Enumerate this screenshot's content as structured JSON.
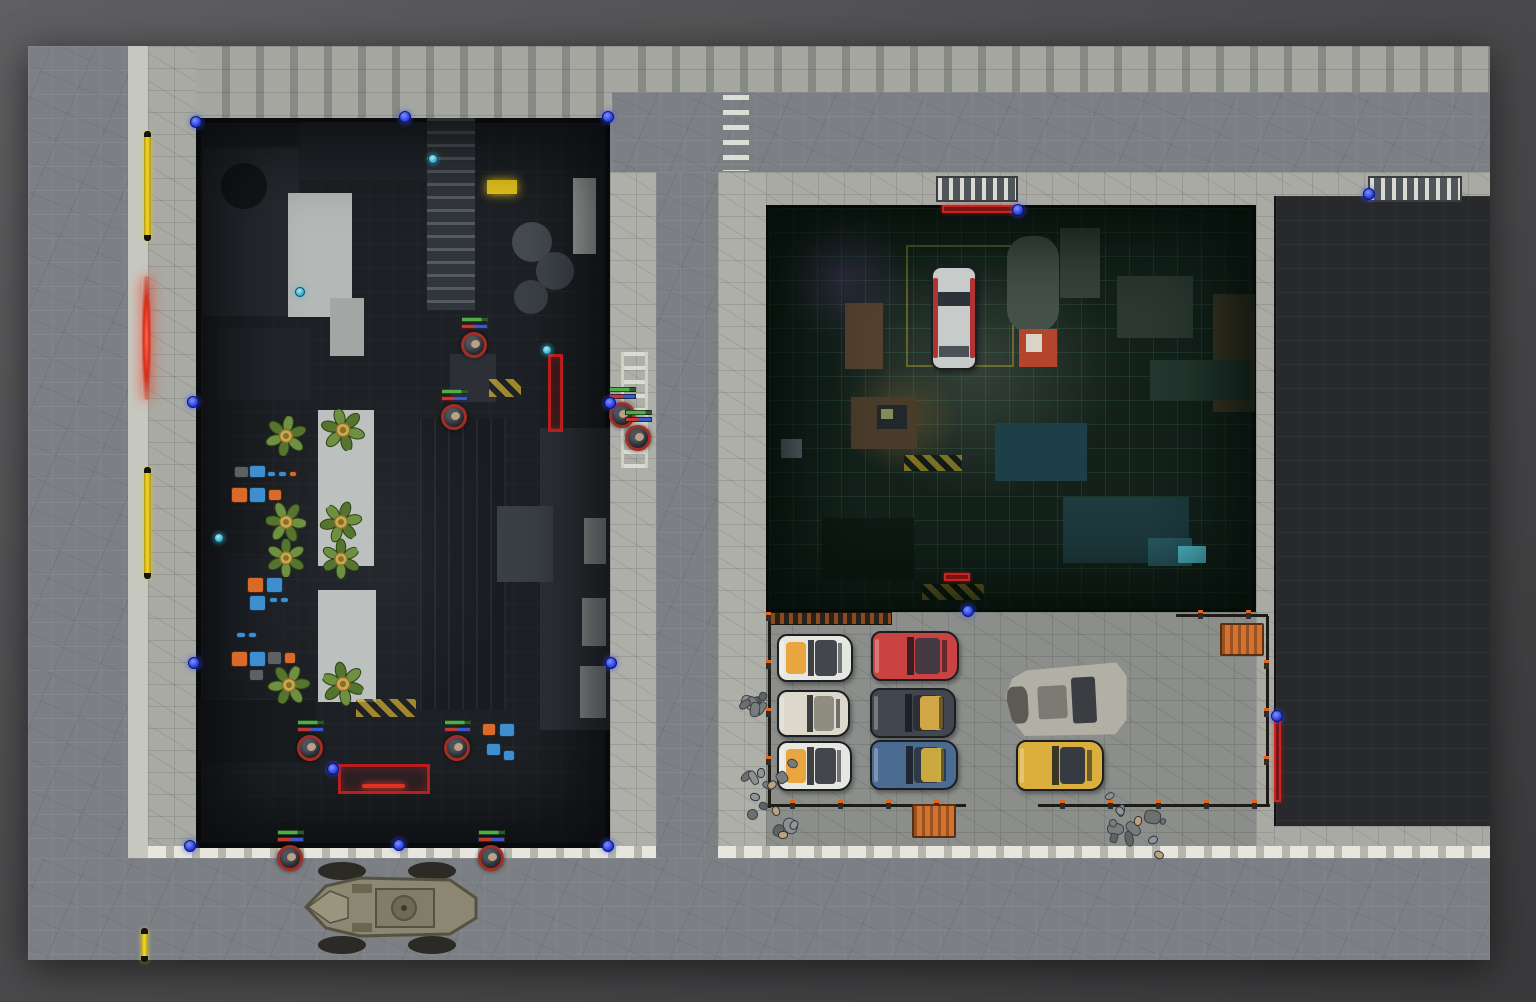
{
  "canvas": {
    "w": 1536,
    "h": 1002
  },
  "scene": {
    "x": 28,
    "y": 46,
    "w": 1462,
    "h": 914,
    "road_color": "#7c8085",
    "pave_color": "#a9aaa3",
    "dark_building_color": "#1d2024",
    "garage_color": "#14211b",
    "black_building_color": "#28292c",
    "grid_size_px": 24
  },
  "regions": [
    {
      "n": "scene-base",
      "i": false,
      "x": 28,
      "y": 46,
      "w": 1462,
      "h": 914,
      "f": "#7c8085",
      "cls": "shadowed"
    },
    {
      "n": "road-vertical-left",
      "i": false,
      "x": 28,
      "y": 46,
      "w": 100,
      "h": 914,
      "f": "#7c8085",
      "cls": "road"
    },
    {
      "n": "curb-left",
      "i": false,
      "x": 128,
      "y": 46,
      "w": 20,
      "h": 914,
      "f": "#c6c7bf",
      "cls": ""
    },
    {
      "n": "sidewalk-left",
      "i": false,
      "x": 148,
      "y": 46,
      "w": 48,
      "h": 914,
      "f": "#a9aaa3",
      "cls": "pave"
    },
    {
      "n": "frontage-top-west",
      "i": false,
      "x": 196,
      "y": 46,
      "w": 416,
      "h": 72,
      "f": "#a6a7a0",
      "cls": "facade"
    },
    {
      "n": "frontage-top-east",
      "i": false,
      "x": 612,
      "y": 46,
      "w": 878,
      "h": 46,
      "f": "#a6a7a0",
      "cls": "facade"
    },
    {
      "n": "road-horizontal-top",
      "i": false,
      "x": 612,
      "y": 92,
      "w": 878,
      "h": 80,
      "f": "#7c8085",
      "cls": "road"
    },
    {
      "n": "sidewalk-mid-west",
      "i": false,
      "x": 610,
      "y": 172,
      "w": 46,
      "h": 788,
      "f": "#aeafa8",
      "cls": "pave"
    },
    {
      "n": "road-vertical-mid",
      "i": false,
      "x": 656,
      "y": 172,
      "w": 62,
      "h": 788,
      "f": "#7c8085",
      "cls": "road"
    },
    {
      "n": "sidewalk-mid-east",
      "i": false,
      "x": 718,
      "y": 172,
      "w": 48,
      "h": 788,
      "f": "#aeafa8",
      "cls": "pave"
    },
    {
      "n": "frontage-garage-top",
      "i": false,
      "x": 766,
      "y": 172,
      "w": 724,
      "h": 33,
      "f": "#a9aaa3",
      "cls": "pave"
    },
    {
      "n": "gutter-right",
      "i": false,
      "x": 1256,
      "y": 172,
      "w": 34,
      "h": 676,
      "f": "#a9aaa3",
      "cls": "pave"
    },
    {
      "n": "parking-lot",
      "i": false,
      "x": 766,
      "y": 612,
      "w": 490,
      "h": 236,
      "f": "#8b8e8a",
      "cls": "pave"
    },
    {
      "n": "pave-southeast",
      "i": false,
      "x": 1274,
      "y": 826,
      "w": 216,
      "h": 22,
      "f": "#a9aaa3",
      "cls": "pave"
    },
    {
      "n": "curb-bottom-west",
      "i": false,
      "x": 148,
      "y": 846,
      "w": 508,
      "h": 12,
      "f": "#c9c9c0",
      "cls": "curb"
    },
    {
      "n": "curb-bottom-east",
      "i": false,
      "x": 718,
      "y": 846,
      "w": 772,
      "h": 12,
      "f": "#c9c9c0",
      "cls": "curb"
    },
    {
      "n": "road-horizontal-bottom",
      "i": false,
      "x": 28,
      "y": 858,
      "w": 1462,
      "h": 102,
      "f": "#7c8085",
      "cls": "road"
    },
    {
      "n": "building-dark-interior",
      "i": false,
      "x": 196,
      "y": 118,
      "w": 414,
      "h": 730,
      "f": "#1d2024",
      "cls": "bgrid"
    },
    {
      "n": "garage-room-interior",
      "i": false,
      "x": 766,
      "y": 205,
      "w": 490,
      "h": 407,
      "f": "#14211b",
      "cls": "ggrid"
    },
    {
      "n": "building-black-roof",
      "i": false,
      "x": 1274,
      "y": 196,
      "w": 216,
      "h": 630,
      "f": "#28292c",
      "cls": "kgrid"
    }
  ],
  "building_shapes": [
    {
      "n": "machinery-block",
      "x": 203,
      "y": 148,
      "w": 96,
      "h": 168,
      "f": "#262a2f"
    },
    {
      "n": "vent-circle",
      "x": 221,
      "y": 163,
      "w": 46,
      "h": 46,
      "f": "#141619",
      "r": "50%"
    },
    {
      "n": "machinery-block",
      "x": 300,
      "y": 122,
      "w": 168,
      "h": 58,
      "f": "#22262b"
    },
    {
      "n": "conveyor-belt",
      "x": 427,
      "y": 118,
      "w": 48,
      "h": 192,
      "f": "#31363c",
      "cls": "rungs"
    },
    {
      "n": "white-counter",
      "x": 288,
      "y": 193,
      "w": 64,
      "h": 124,
      "f": "#b4b8b7"
    },
    {
      "n": "white-counter-small",
      "x": 330,
      "y": 298,
      "w": 34,
      "h": 58,
      "f": "#a2a6a5"
    },
    {
      "n": "white-shelf",
      "x": 573,
      "y": 178,
      "w": 23,
      "h": 76,
      "f": "#aeb2b0"
    },
    {
      "n": "dark-cabinet",
      "x": 218,
      "y": 328,
      "w": 92,
      "h": 72,
      "f": "#22252a"
    },
    {
      "n": "tank-circle",
      "x": 512,
      "y": 222,
      "w": 40,
      "h": 40,
      "f": "#474c52",
      "r": "50%"
    },
    {
      "n": "tank-circle",
      "x": 536,
      "y": 252,
      "w": 38,
      "h": 38,
      "f": "#42474d",
      "r": "50%"
    },
    {
      "n": "tank-circle",
      "x": 514,
      "y": 280,
      "w": 34,
      "h": 34,
      "f": "#3d4248",
      "r": "50%"
    },
    {
      "n": "machine-box",
      "x": 450,
      "y": 354,
      "w": 46,
      "h": 48,
      "f": "#2c3036"
    },
    {
      "n": "lamp-yellow",
      "x": 487,
      "y": 180,
      "w": 30,
      "h": 14,
      "f": "#e6c51d",
      "glow": "#e6c51d"
    },
    {
      "n": "hazard-strip",
      "x": 489,
      "y": 379,
      "w": 32,
      "h": 18,
      "cls": "hazard"
    },
    {
      "n": "white-table",
      "x": 318,
      "y": 410,
      "w": 56,
      "h": 156,
      "f": "#bcc0be"
    },
    {
      "n": "white-table",
      "x": 318,
      "y": 590,
      "w": 58,
      "h": 112,
      "f": "#bcc0be"
    },
    {
      "n": "shelving-dark",
      "x": 420,
      "y": 418,
      "w": 86,
      "h": 292,
      "f": "#191c20",
      "cls": "vlines"
    },
    {
      "n": "floor-light-area",
      "x": 540,
      "y": 428,
      "w": 70,
      "h": 302,
      "f": "#2e3238"
    },
    {
      "n": "white-pillar",
      "x": 584,
      "y": 518,
      "w": 22,
      "h": 46,
      "f": "#989e9d"
    },
    {
      "n": "white-pillar",
      "x": 582,
      "y": 598,
      "w": 24,
      "h": 48,
      "f": "#989e9d"
    },
    {
      "n": "white-pillar",
      "x": 580,
      "y": 666,
      "w": 26,
      "h": 52,
      "f": "#989e9d"
    },
    {
      "n": "robot-mech",
      "x": 497,
      "y": 506,
      "w": 56,
      "h": 76,
      "f": "#3b4046"
    },
    {
      "n": "hazard-strip",
      "x": 356,
      "y": 699,
      "w": 60,
      "h": 18,
      "cls": "hazard"
    },
    {
      "n": "dark-counter",
      "x": 224,
      "y": 558,
      "w": 62,
      "h": 122,
      "f": "#1f2328"
    },
    {
      "n": "dark-block",
      "x": 198,
      "y": 700,
      "w": 118,
      "h": 62,
      "f": "#191c1f"
    },
    {
      "n": "counter-ledge",
      "x": 342,
      "y": 768,
      "w": 84,
      "h": 22,
      "f": "#24272c"
    },
    {
      "n": "interior-light",
      "x": 250,
      "y": 380,
      "w": 260,
      "h": 340,
      "g": "rgba(190,200,210,0.05)"
    }
  ],
  "garage_items": [
    {
      "n": "glow-purple",
      "x": 778,
      "y": 212,
      "w": 130,
      "h": 130,
      "g": "rgba(150,95,210,0.20)"
    },
    {
      "n": "glow-center",
      "x": 830,
      "y": 240,
      "w": 290,
      "h": 260,
      "g": "rgba(200,210,185,0.18)"
    },
    {
      "n": "glow-warm",
      "x": 840,
      "y": 365,
      "w": 120,
      "h": 110,
      "g": "rgba(225,155,60,0.22)"
    },
    {
      "n": "parking-bay-lines",
      "x": 906,
      "y": 245,
      "w": 108,
      "h": 122,
      "b": "2px solid rgba(185,165,45,0.45)"
    },
    {
      "n": "shelf-unit",
      "x": 845,
      "y": 303,
      "w": 38,
      "h": 66,
      "f": "#53422e"
    },
    {
      "n": "tanker-vehicle",
      "x": 1007,
      "y": 236,
      "w": 52,
      "h": 96,
      "f": "#44524a",
      "r": "22px"
    },
    {
      "n": "machinery-top",
      "x": 1060,
      "y": 228,
      "w": 40,
      "h": 70,
      "f": "#37443c"
    },
    {
      "n": "service-cart",
      "x": 1019,
      "y": 329,
      "w": 38,
      "h": 38,
      "f": "#b2452c"
    },
    {
      "n": "cart-top",
      "x": 1026,
      "y": 334,
      "w": 16,
      "h": 18,
      "f": "#d8d4c8"
    },
    {
      "n": "work-desk",
      "x": 851,
      "y": 397,
      "w": 66,
      "h": 52,
      "f": "#4a3c2a"
    },
    {
      "n": "desk-monitor",
      "x": 877,
      "y": 405,
      "w": 30,
      "h": 24,
      "f": "#22272b"
    },
    {
      "n": "monitor-screen",
      "x": 881,
      "y": 409,
      "w": 12,
      "h": 10,
      "f": "#7f8c55"
    },
    {
      "n": "tall-crate",
      "x": 1213,
      "y": 294,
      "w": 42,
      "h": 118,
      "f": "#3d3926"
    },
    {
      "n": "fan-machine",
      "x": 1117,
      "y": 276,
      "w": 76,
      "h": 62,
      "f": "#2b3932"
    },
    {
      "n": "bench-right",
      "x": 1150,
      "y": 360,
      "w": 100,
      "h": 40,
      "f": "#243830"
    },
    {
      "n": "cloth-table",
      "x": 995,
      "y": 423,
      "w": 92,
      "h": 58,
      "f": "#1d3f48"
    },
    {
      "n": "lab-bench",
      "x": 1063,
      "y": 497,
      "w": 126,
      "h": 66,
      "f": "#1e3b40"
    },
    {
      "n": "lab-glow",
      "x": 1148,
      "y": 538,
      "w": 44,
      "h": 28,
      "f": "#2a5c66"
    },
    {
      "n": "lab-screen",
      "x": 1178,
      "y": 546,
      "w": 28,
      "h": 17,
      "f": "#54c4d4"
    },
    {
      "n": "dark-storage",
      "x": 822,
      "y": 518,
      "w": 92,
      "h": 62,
      "f": "#0f1a14"
    },
    {
      "n": "hazard-floor",
      "x": 904,
      "y": 455,
      "w": 58,
      "h": 16,
      "cls": "hazard2"
    },
    {
      "n": "hazard-floor",
      "x": 922,
      "y": 584,
      "w": 62,
      "h": 16,
      "cls": "hazard2"
    },
    {
      "n": "window-tile",
      "x": 781,
      "y": 439,
      "w": 21,
      "h": 19,
      "f": "#66737f"
    }
  ],
  "garage_car": {
    "x": 931,
    "y": 266,
    "w": 46,
    "h": 104,
    "body": "#c7cbc9",
    "trim": "#b13434",
    "glass": "#2c3338"
  },
  "machine_colors": {
    "o": "#d96a2a",
    "b": "#3f8ed0",
    "g": "#5d6166"
  },
  "machines": [
    [
      234,
      466,
      15,
      12,
      "g"
    ],
    [
      249,
      465,
      17,
      13,
      "b"
    ],
    [
      267,
      471,
      9,
      6,
      "b"
    ],
    [
      278,
      471,
      9,
      6,
      "b"
    ],
    [
      289,
      471,
      8,
      6,
      "o"
    ],
    [
      231,
      487,
      17,
      16,
      "o"
    ],
    [
      249,
      487,
      17,
      16,
      "b"
    ],
    [
      268,
      489,
      14,
      12,
      "o"
    ],
    [
      247,
      577,
      17,
      16,
      "o"
    ],
    [
      266,
      577,
      17,
      16,
      "b"
    ],
    [
      249,
      595,
      17,
      16,
      "b"
    ],
    [
      269,
      597,
      9,
      6,
      "b"
    ],
    [
      280,
      597,
      9,
      6,
      "b"
    ],
    [
      236,
      632,
      10,
      6,
      "b"
    ],
    [
      248,
      632,
      9,
      6,
      "b"
    ],
    [
      231,
      651,
      17,
      16,
      "o"
    ],
    [
      249,
      651,
      17,
      16,
      "b"
    ],
    [
      267,
      651,
      15,
      14,
      "g"
    ],
    [
      284,
      652,
      12,
      12,
      "o"
    ],
    [
      249,
      669,
      15,
      12,
      "g"
    ],
    [
      482,
      723,
      14,
      13,
      "o"
    ],
    [
      499,
      723,
      16,
      14,
      "b"
    ],
    [
      486,
      743,
      15,
      13,
      "b"
    ],
    [
      503,
      750,
      12,
      11,
      "b"
    ]
  ],
  "plants": [
    {
      "x": 286,
      "y": 436,
      "s": 40,
      "r": 10
    },
    {
      "x": 343,
      "y": 430,
      "s": 42,
      "r": -15
    },
    {
      "x": 286,
      "y": 522,
      "s": 40,
      "r": 95
    },
    {
      "x": 341,
      "y": 522,
      "s": 40,
      "r": -40
    },
    {
      "x": 286,
      "y": 558,
      "s": 38,
      "r": 180
    },
    {
      "x": 341,
      "y": 559,
      "s": 38,
      "r": 60
    },
    {
      "x": 289,
      "y": 685,
      "s": 40,
      "r": 25
    },
    {
      "x": 343,
      "y": 684,
      "s": 42,
      "r": -70
    }
  ],
  "plant_colors": {
    "leaf_a": "#6d9140",
    "leaf_b": "#55742e",
    "stroke": "#2f4418",
    "center": "#c9a94e",
    "center_dark": "#8a6f2a"
  },
  "tokens": [
    {
      "x": 475,
      "y": 345
    },
    {
      "x": 455,
      "y": 417
    },
    {
      "x": 623,
      "y": 415
    },
    {
      "x": 639,
      "y": 438
    },
    {
      "x": 311,
      "y": 748
    },
    {
      "x": 458,
      "y": 748
    },
    {
      "x": 291,
      "y": 858
    },
    {
      "x": 492,
      "y": 858
    }
  ],
  "token_style": {
    "ring": "#a32c24",
    "bar_top": "#4fae47",
    "bar_left": "#c23830",
    "bar_right": "#3a58c8",
    "face": "#c9a88b"
  },
  "wall_dots": [
    [
      196,
      122
    ],
    [
      405,
      117
    ],
    [
      608,
      117
    ],
    [
      193,
      402
    ],
    [
      194,
      663
    ],
    [
      190,
      846
    ],
    [
      610,
      403
    ],
    [
      611,
      663
    ],
    [
      608,
      846
    ],
    [
      333,
      769
    ],
    [
      399,
      845
    ],
    [
      968,
      611
    ],
    [
      1018,
      210
    ],
    [
      1369,
      194
    ],
    [
      1277,
      716
    ]
  ],
  "light_dots": [
    [
      433,
      159
    ],
    [
      300,
      292
    ],
    [
      547,
      350
    ],
    [
      219,
      538
    ]
  ],
  "doors_yellow": [
    {
      "x": 144,
      "y": 131,
      "w": 7,
      "h": 110
    },
    {
      "x": 144,
      "y": 467,
      "w": 7,
      "h": 112
    },
    {
      "x": 141,
      "y": 928,
      "w": 7,
      "h": 34
    }
  ],
  "door_red_glow": {
    "x": 142,
    "y": 276,
    "w": 9,
    "h": 124
  },
  "red_rects": [
    {
      "x": 548,
      "y": 354,
      "w": 15,
      "h": 78
    },
    {
      "x": 338,
      "y": 764,
      "w": 92,
      "h": 30,
      "glow": true
    }
  ],
  "red_lines": [
    {
      "x": 942,
      "y": 205,
      "w": 72,
      "h": 8
    },
    {
      "x": 944,
      "y": 573,
      "w": 26,
      "h": 8
    },
    {
      "x": 1374,
      "y": 190,
      "w": 84,
      "h": 8
    },
    {
      "x": 1274,
      "y": 718,
      "w": 7,
      "h": 84
    }
  ],
  "gates": [
    {
      "x": 936,
      "y": 176,
      "w": 82,
      "h": 26
    },
    {
      "x": 1368,
      "y": 176,
      "w": 94,
      "h": 26
    }
  ],
  "rails": [
    {
      "x": 770,
      "y": 612,
      "w": 122,
      "h": 13
    }
  ],
  "fence_lines": [
    {
      "x": 768,
      "y": 616,
      "w": 3,
      "h": 192
    },
    {
      "x": 768,
      "y": 804,
      "w": 198,
      "h": 3
    },
    {
      "x": 1038,
      "y": 804,
      "w": 232,
      "h": 3
    },
    {
      "x": 1266,
      "y": 616,
      "w": 3,
      "h": 190
    },
    {
      "x": 1176,
      "y": 614,
      "w": 92,
      "h": 3
    }
  ],
  "fence_posts": [
    [
      768,
      616
    ],
    [
      768,
      664
    ],
    [
      768,
      712
    ],
    [
      768,
      760
    ],
    [
      792,
      804
    ],
    [
      840,
      804
    ],
    [
      888,
      804
    ],
    [
      936,
      804
    ],
    [
      1062,
      804
    ],
    [
      1110,
      804
    ],
    [
      1158,
      804
    ],
    [
      1206,
      804
    ],
    [
      1254,
      804
    ],
    [
      1266,
      664
    ],
    [
      1266,
      712
    ],
    [
      1266,
      760
    ],
    [
      1200,
      614
    ],
    [
      1248,
      614
    ]
  ],
  "containers": [
    {
      "x": 912,
      "y": 804,
      "w": 44,
      "h": 34
    },
    {
      "x": 1220,
      "y": 623,
      "w": 44,
      "h": 33
    }
  ],
  "cars": [
    {
      "x": 777,
      "y": 634,
      "w": 76,
      "h": 48,
      "body": "#e7e7e1",
      "hood": "#eaa63e",
      "roof": "#43464c"
    },
    {
      "x": 871,
      "y": 631,
      "w": 88,
      "h": 50,
      "body": "#cb4242",
      "roof": "#453a44"
    },
    {
      "x": 777,
      "y": 690,
      "w": 73,
      "h": 47,
      "body": "#dcd8cb",
      "roof": "#8f8c80"
    },
    {
      "x": 870,
      "y": 688,
      "w": 86,
      "h": 50,
      "body": "#42474f",
      "hood": "#e0b148",
      "side": "right",
      "roof": "#2c3036"
    },
    {
      "x": 777,
      "y": 741,
      "w": 75,
      "h": 50,
      "body": "#e7e7e1",
      "hood": "#eaa63e",
      "roof": "#43464c"
    },
    {
      "x": 870,
      "y": 740,
      "w": 88,
      "h": 50,
      "body": "#4a6b92",
      "hood": "#d8b440",
      "side": "right",
      "roof": "#2f3a46"
    },
    {
      "x": 1016,
      "y": 740,
      "w": 88,
      "h": 51,
      "body": "#dcae3c",
      "roof": "#363b42"
    }
  ],
  "wreck": {
    "x": 1006,
    "y": 662,
    "w": 122,
    "h": 78,
    "rot": -3,
    "body": "#b2afa5",
    "damage": "#5c5a52",
    "glass": "#3a3d42"
  },
  "apc": {
    "x": 298,
    "y": 860,
    "w": 190,
    "h": 96,
    "hull": "#8c8772",
    "hull_dark": "#55523f",
    "plate": "#827d68",
    "turret": "#6e6a56",
    "wheel": "#2b2a24"
  },
  "crosswalk": {
    "x": 723,
    "y": 95,
    "w": 26,
    "h": 76
  },
  "ladder": {
    "x": 621,
    "y": 352,
    "w": 27,
    "h": 116
  },
  "rubble": [
    {
      "x": 738,
      "y": 752,
      "w": 64,
      "h": 92
    },
    {
      "x": 740,
      "y": 688,
      "w": 32,
      "h": 30
    },
    {
      "x": 1096,
      "y": 790,
      "w": 72,
      "h": 62
    }
  ],
  "figures": [
    [
      757,
      768
    ],
    [
      768,
      780
    ],
    [
      751,
      792
    ],
    [
      772,
      806
    ],
    [
      790,
      820
    ],
    [
      779,
      830
    ],
    [
      1116,
      806
    ],
    [
      1134,
      816
    ],
    [
      1149,
      835
    ],
    [
      1155,
      850
    ]
  ]
}
